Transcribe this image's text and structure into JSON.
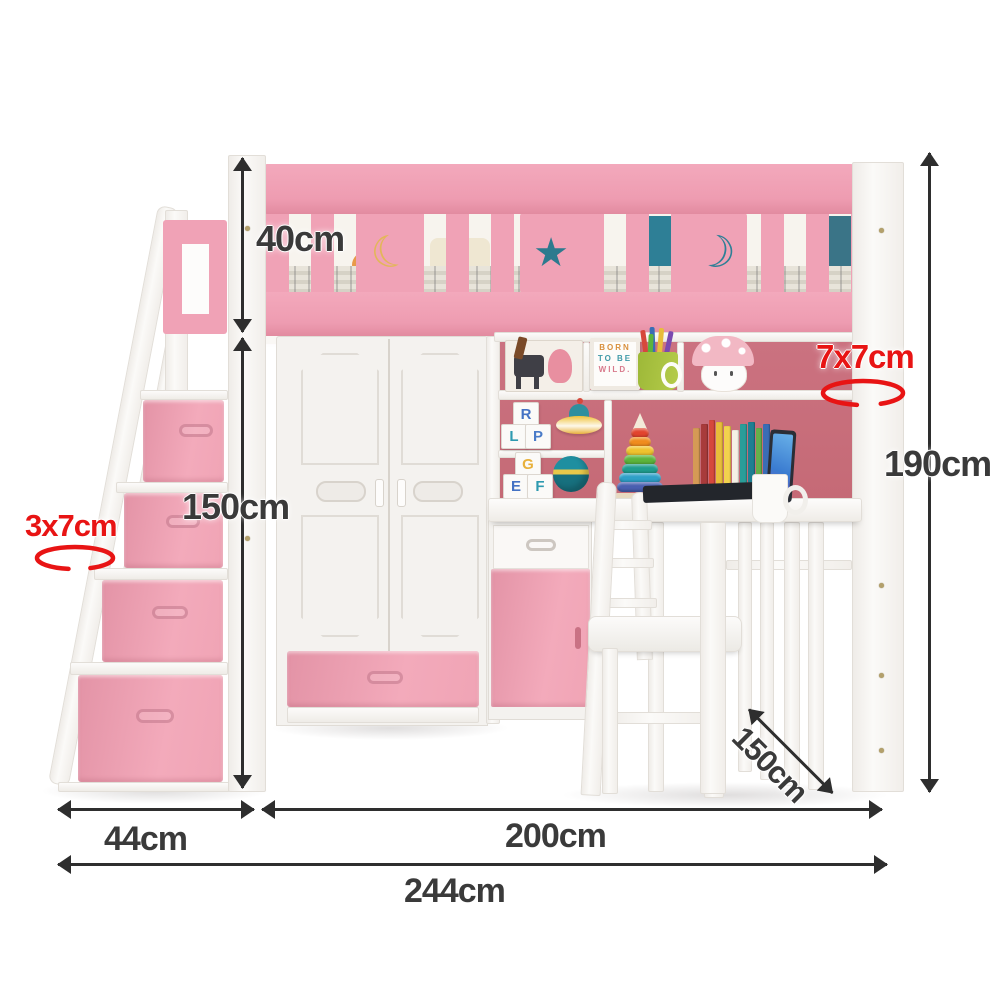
{
  "labels": {
    "rail_height": "40cm",
    "under_height": "150cm",
    "total_height": "190cm",
    "stair_post_size": "3x7cm",
    "bed_post_size": "7x7cm",
    "depth": "150cm",
    "stair_width": "44cm",
    "bed_length": "200cm",
    "total_width": "244cm"
  },
  "decor": {
    "sign": {
      "line1": "BORN",
      "line2": "TO BE",
      "line3": "WILD."
    },
    "blocks_top": [
      {
        "letter": "R",
        "color": "#4472c4"
      },
      {
        "letter": "L",
        "color": "#2e9ab0"
      },
      {
        "letter": "P",
        "color": "#4a7bc8"
      }
    ],
    "blocks_bottom": [
      {
        "letter": "G",
        "color": "#e8b13c"
      },
      {
        "letter": "E",
        "color": "#4472c4"
      },
      {
        "letter": "F",
        "color": "#2e9ab0"
      }
    ],
    "book_spines": [
      {
        "color": "#d59a55",
        "h": 72
      },
      {
        "color": "#a83b3b",
        "h": 76
      },
      {
        "color": "#d6483c",
        "h": 80
      },
      {
        "color": "#e8bd3a",
        "h": 78
      },
      {
        "color": "#f2d24e",
        "h": 74
      },
      {
        "color": "#f5f1e6",
        "h": 70
      },
      {
        "color": "#2a9d99",
        "h": 76
      },
      {
        "color": "#1f7f92",
        "h": 78
      },
      {
        "color": "#66b04a",
        "h": 72
      },
      {
        "color": "#3a6db5",
        "h": 76
      },
      {
        "color": "#2b4a6f",
        "h": 70
      }
    ],
    "stacker_rings": [
      "#4a5fb0",
      "#2ea0c8",
      "#1f9d8e",
      "#5cb43c",
      "#f0c22e",
      "#f08c1e",
      "#e2442e"
    ]
  },
  "colors": {
    "pink": "#f0a2b6",
    "pink_dark": "#e28ba0",
    "rose_back_panel": "#c86e7a",
    "white_wood": "#f7f5f2",
    "dim_text": "#3a3a3a",
    "red_label": "#e81414",
    "bedding_teal": "#2e7f96"
  }
}
